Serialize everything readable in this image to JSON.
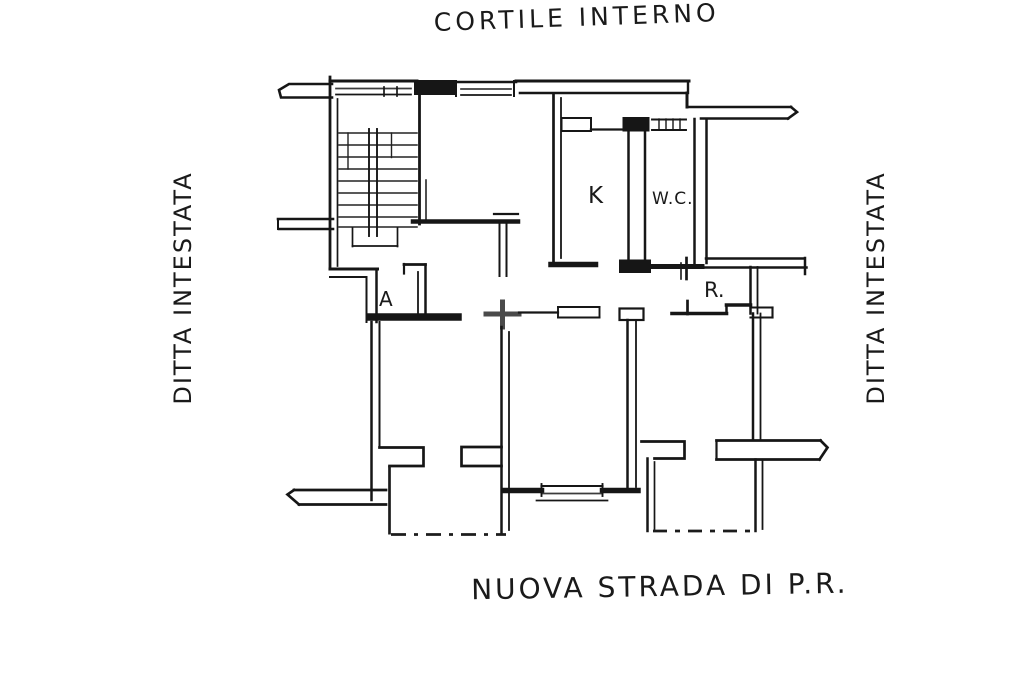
{
  "document": {
    "type": "hand-drawn cadastral floor plan (scanned)",
    "background": "#ffffff",
    "ink_color": "#1a1a1a"
  },
  "surround_labels": {
    "top": "CORTILE INTERNO",
    "bottom": "NUOVA STRADA DI P.R.",
    "left": "DITTA INTESTATA",
    "right": "DITTA INTESTATA"
  },
  "room_labels": [
    {
      "id": "kitchen",
      "text": "K"
    },
    {
      "id": "wc",
      "text": "W.C."
    },
    {
      "id": "anteroom",
      "text": "A"
    },
    {
      "id": "closet",
      "text": "R."
    }
  ]
}
